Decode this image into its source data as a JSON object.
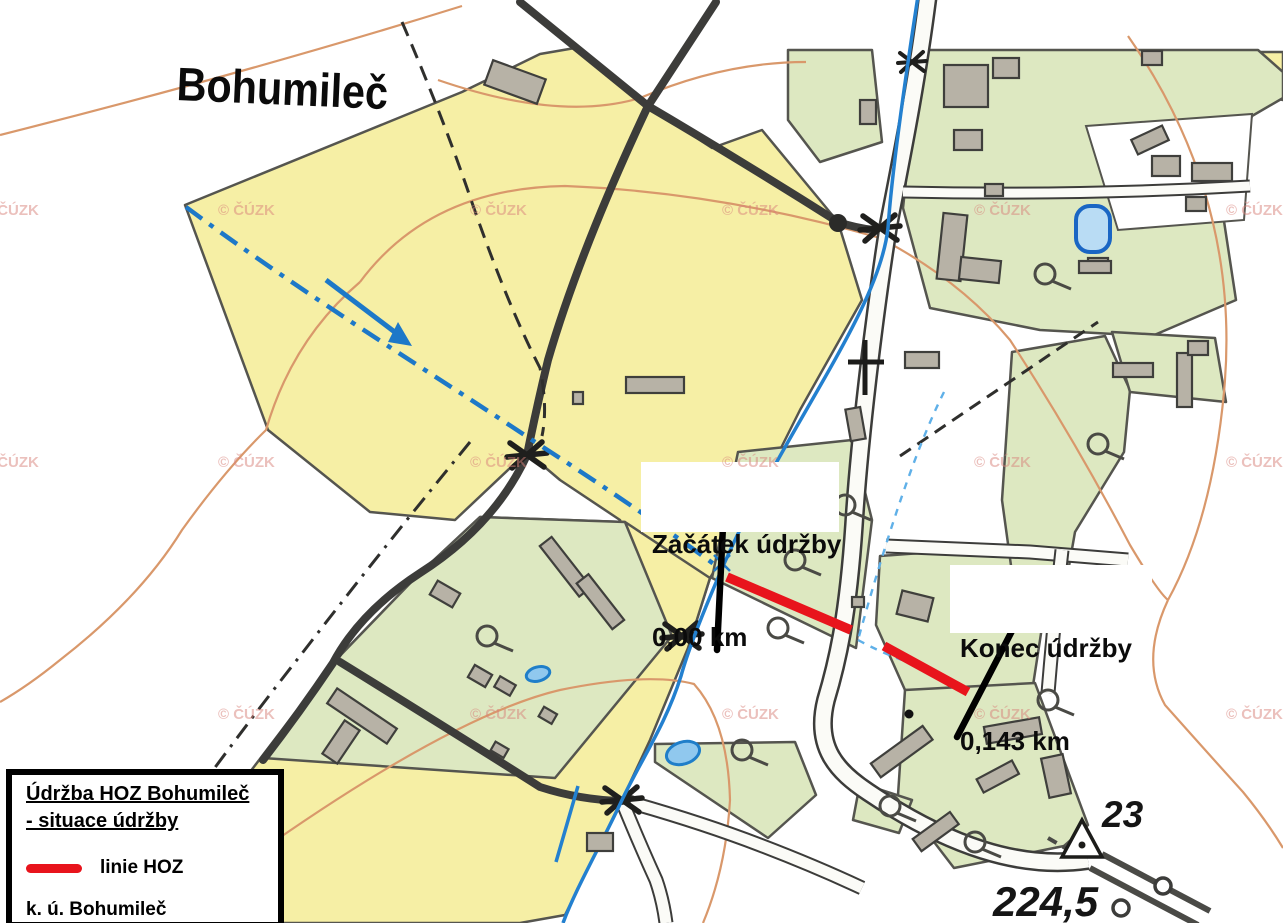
{
  "map": {
    "place_label": "Bohumileč",
    "watermark": "© ČÚZK",
    "annotations": {
      "start": {
        "line1": "Začátek údržby",
        "line2": "0,00 km"
      },
      "end": {
        "line1": "Konec údržby",
        "line2": "0,143 km"
      }
    },
    "spot_symbols": {
      "trig_point_number": "23",
      "elevation": "224,5"
    }
  },
  "legend": {
    "title_line1": "Údržba HOZ Bohumileč",
    "title_line2": "- situace údržby",
    "line_item_label": "linie HOZ",
    "area_label": "k. ú. Bohumileč"
  },
  "colors": {
    "field_yellow": "#f6efa5",
    "meadow_green": "#dde8c1",
    "building_gray": "#b7b2a6",
    "road_dark": "#3c3c3a",
    "contour_orange": "#d9986b",
    "water_blue": "#2380cf",
    "channel_blue": "#1d78c8",
    "hoz_line_red": "#e8141c",
    "watermark_pink": "#d9837c"
  }
}
